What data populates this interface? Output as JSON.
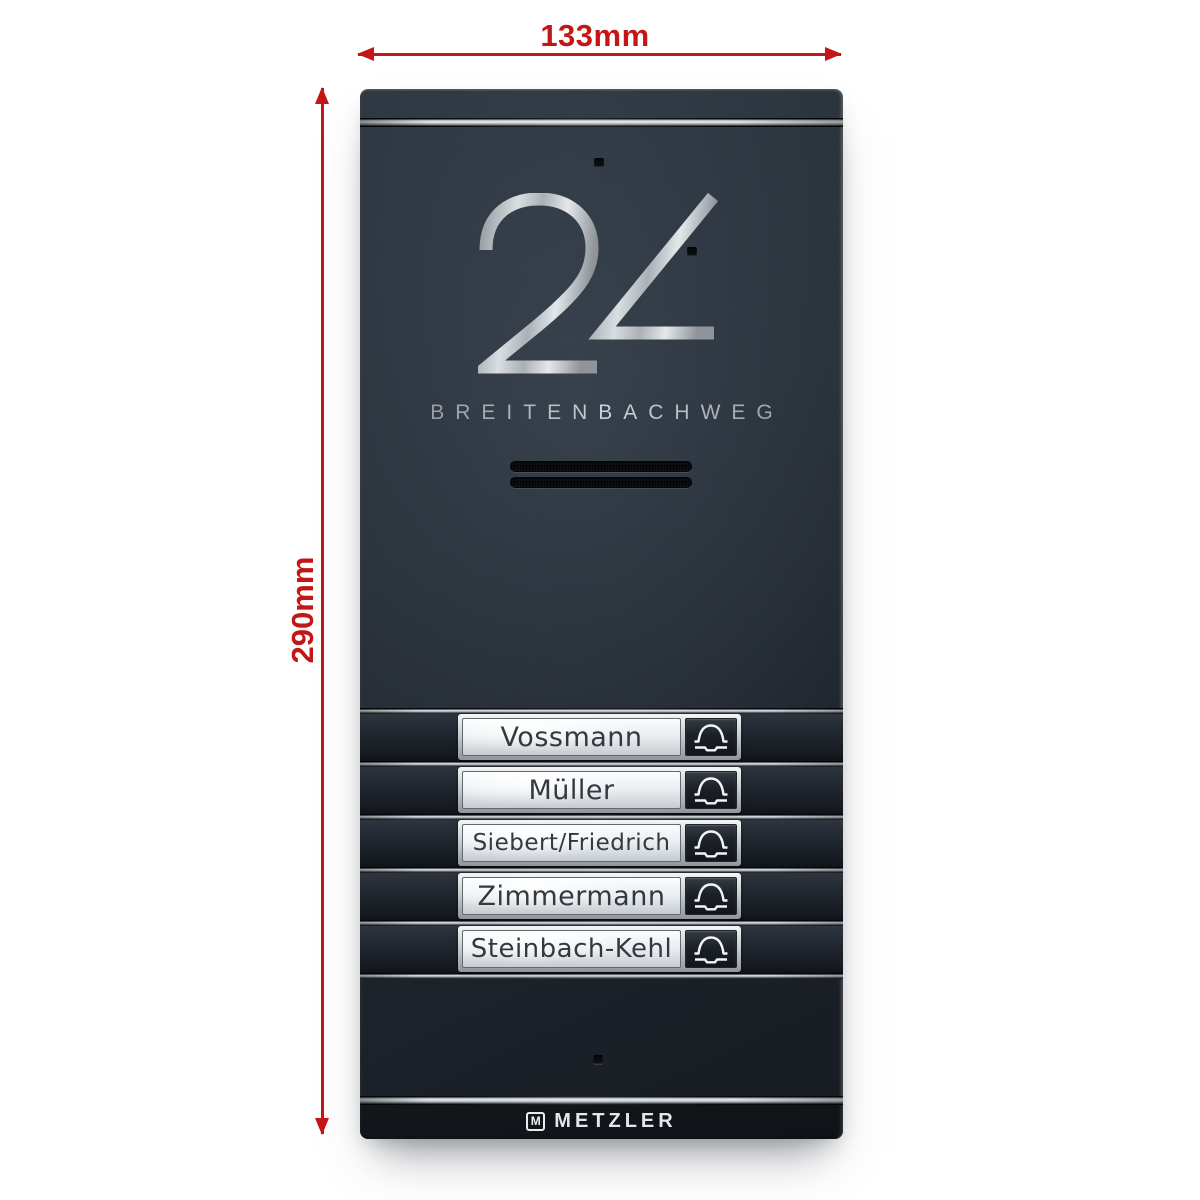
{
  "annotations": {
    "width_label": "133mm",
    "height_label": "290mm"
  },
  "panel": {
    "house_number": "24",
    "street_name": "BREITENBACHWEG",
    "doorbells": [
      {
        "name": "Vossmann"
      },
      {
        "name": "Müller"
      },
      {
        "name": "Siebert/Friedrich"
      },
      {
        "name": "Zimmermann"
      },
      {
        "name": "Steinbach-Kehl"
      }
    ],
    "brand": {
      "logo_letter": "M",
      "wordmark": "METZLER"
    }
  },
  "icons": {
    "bell": "bell-icon",
    "speaker": "speaker-grille"
  },
  "colors": {
    "dimension_accent": "#c41616",
    "panel_anthracite": "#232a32",
    "stainless_steel": "#b9bec3",
    "plate_silver": "#eef1f3"
  }
}
